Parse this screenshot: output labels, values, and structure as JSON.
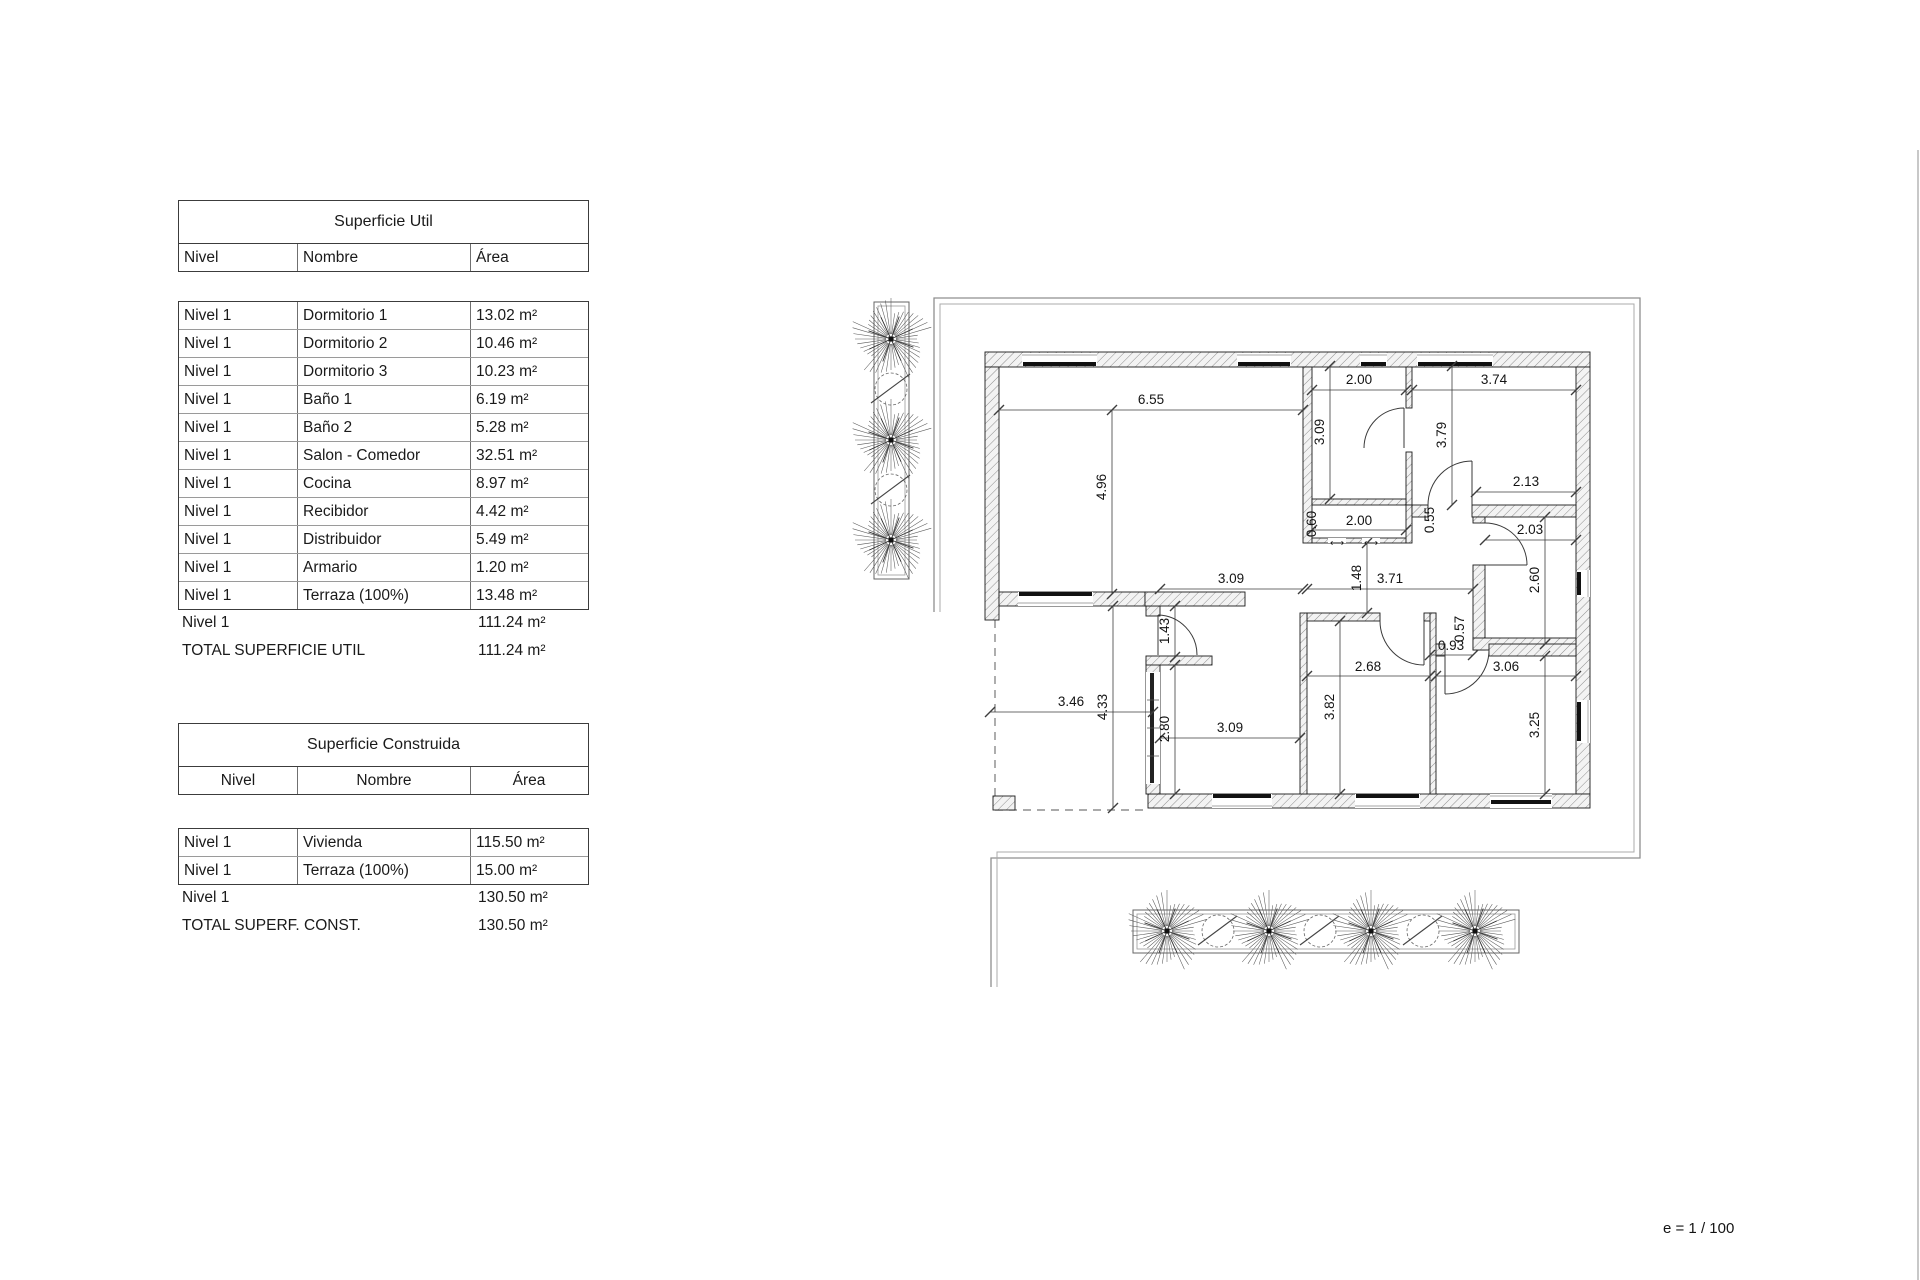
{
  "tables": {
    "util": {
      "title": "Superficie Util",
      "headers": [
        "Nivel",
        "Nombre",
        "Área"
      ],
      "rows": [
        [
          "Nivel 1",
          "Dormitorio 1",
          "13.02 m²"
        ],
        [
          "Nivel 1",
          "Dormitorio 2",
          "10.46 m²"
        ],
        [
          "Nivel 1",
          "Dormitorio 3",
          "10.23 m²"
        ],
        [
          "Nivel 1",
          "Baño 1",
          "6.19 m²"
        ],
        [
          "Nivel 1",
          "Baño 2",
          "5.28 m²"
        ],
        [
          "Nivel 1",
          "Salon - Comedor",
          "32.51 m²"
        ],
        [
          "Nivel 1",
          "Cocina",
          "8.97 m²"
        ],
        [
          "Nivel 1",
          "Recibidor",
          "4.42 m²"
        ],
        [
          "Nivel 1",
          "Distribuidor",
          "5.49 m²"
        ],
        [
          "Nivel 1",
          "Armario",
          "1.20 m²"
        ],
        [
          "Nivel 1",
          "Terraza (100%)",
          "13.48 m²"
        ]
      ],
      "subtotal": {
        "label": "Nivel 1",
        "value": "111.24 m²"
      },
      "total": {
        "label": "TOTAL SUPERFICIE UTIL",
        "value": "111.24 m²"
      }
    },
    "construida": {
      "title": "Superficie Construida",
      "headers": [
        "Nivel",
        "Nombre",
        "Área"
      ],
      "rows": [
        [
          "Nivel 1",
          "Vivienda",
          "115.50 m²"
        ],
        [
          "Nivel 1",
          "Terraza (100%)",
          "15.00 m²"
        ]
      ],
      "subtotal": {
        "label": "Nivel 1",
        "value": "130.50 m²"
      },
      "total": {
        "label": "TOTAL SUPERF. CONST.",
        "value": "130.50 m²"
      }
    }
  },
  "plan": {
    "scale_note": "e = 1 / 100",
    "icons": {
      "sliding_door": "⟷"
    },
    "dims": [
      "6.55",
      "2.00",
      "3.74",
      "2.00",
      "2.13",
      "2.03",
      "3.09",
      "3.71",
      "0.93",
      "3.06",
      "2.68",
      "3.09",
      "3.46",
      "4.96",
      "3.09",
      "3.79",
      "1.48",
      "2.60",
      "1.43",
      "4.33",
      "2.80",
      "3.82",
      "3.25",
      "0.60",
      "0.55",
      "0.57"
    ]
  }
}
